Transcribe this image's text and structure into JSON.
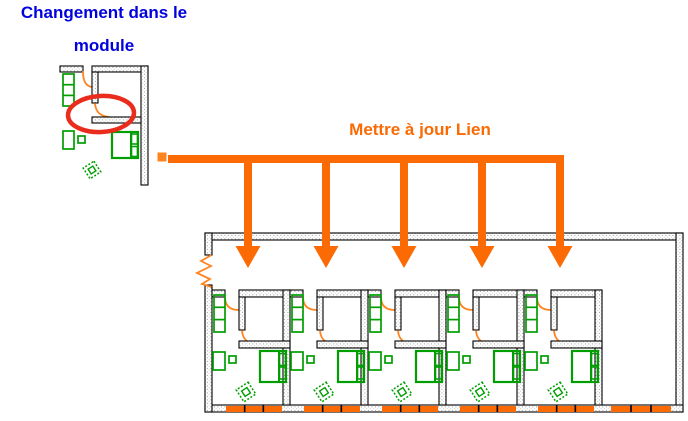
{
  "title": {
    "line1": "Changement dans le",
    "line2": "module"
  },
  "link": {
    "text": "Mettre à jour Lien"
  },
  "colors": {
    "title_blue": "#0202dd",
    "accent_orange": "#fb6a03",
    "cad_orange": "#ff8420",
    "furniture_green": "#009e00",
    "highlight_red": "#ea2c1c",
    "wall_edge": "#000000",
    "wall_dot": "#9b9b9b",
    "background": "#ffffff"
  },
  "scene": {
    "arrows": {
      "bar_x1": 168,
      "bar_x2": 564,
      "bar_y": 155,
      "bar_h": 8,
      "xs": [
        248,
        326,
        404,
        482,
        560
      ],
      "shaft_w": 8,
      "head_top_y": 246,
      "head_half_w": 12.5,
      "tip_y": 268
    },
    "building": {
      "left": 205,
      "top": 233,
      "right": 683,
      "bottom": 412,
      "wall_t": 7,
      "inner_wall_y": 290,
      "module_count": 5,
      "module_start_x": 212,
      "module_pitch": 78,
      "break_gap_y1": 255,
      "break_gap_y2": 285,
      "right_windows": {
        "x": 611,
        "w": 60
      }
    },
    "source_module": {
      "left": 60,
      "top": 66,
      "right": 148,
      "bottom": 185,
      "ellipse": {
        "cx": 101,
        "cy": 114,
        "rx": 33,
        "ry": 18,
        "stroke_w": 4.5
      }
    }
  }
}
